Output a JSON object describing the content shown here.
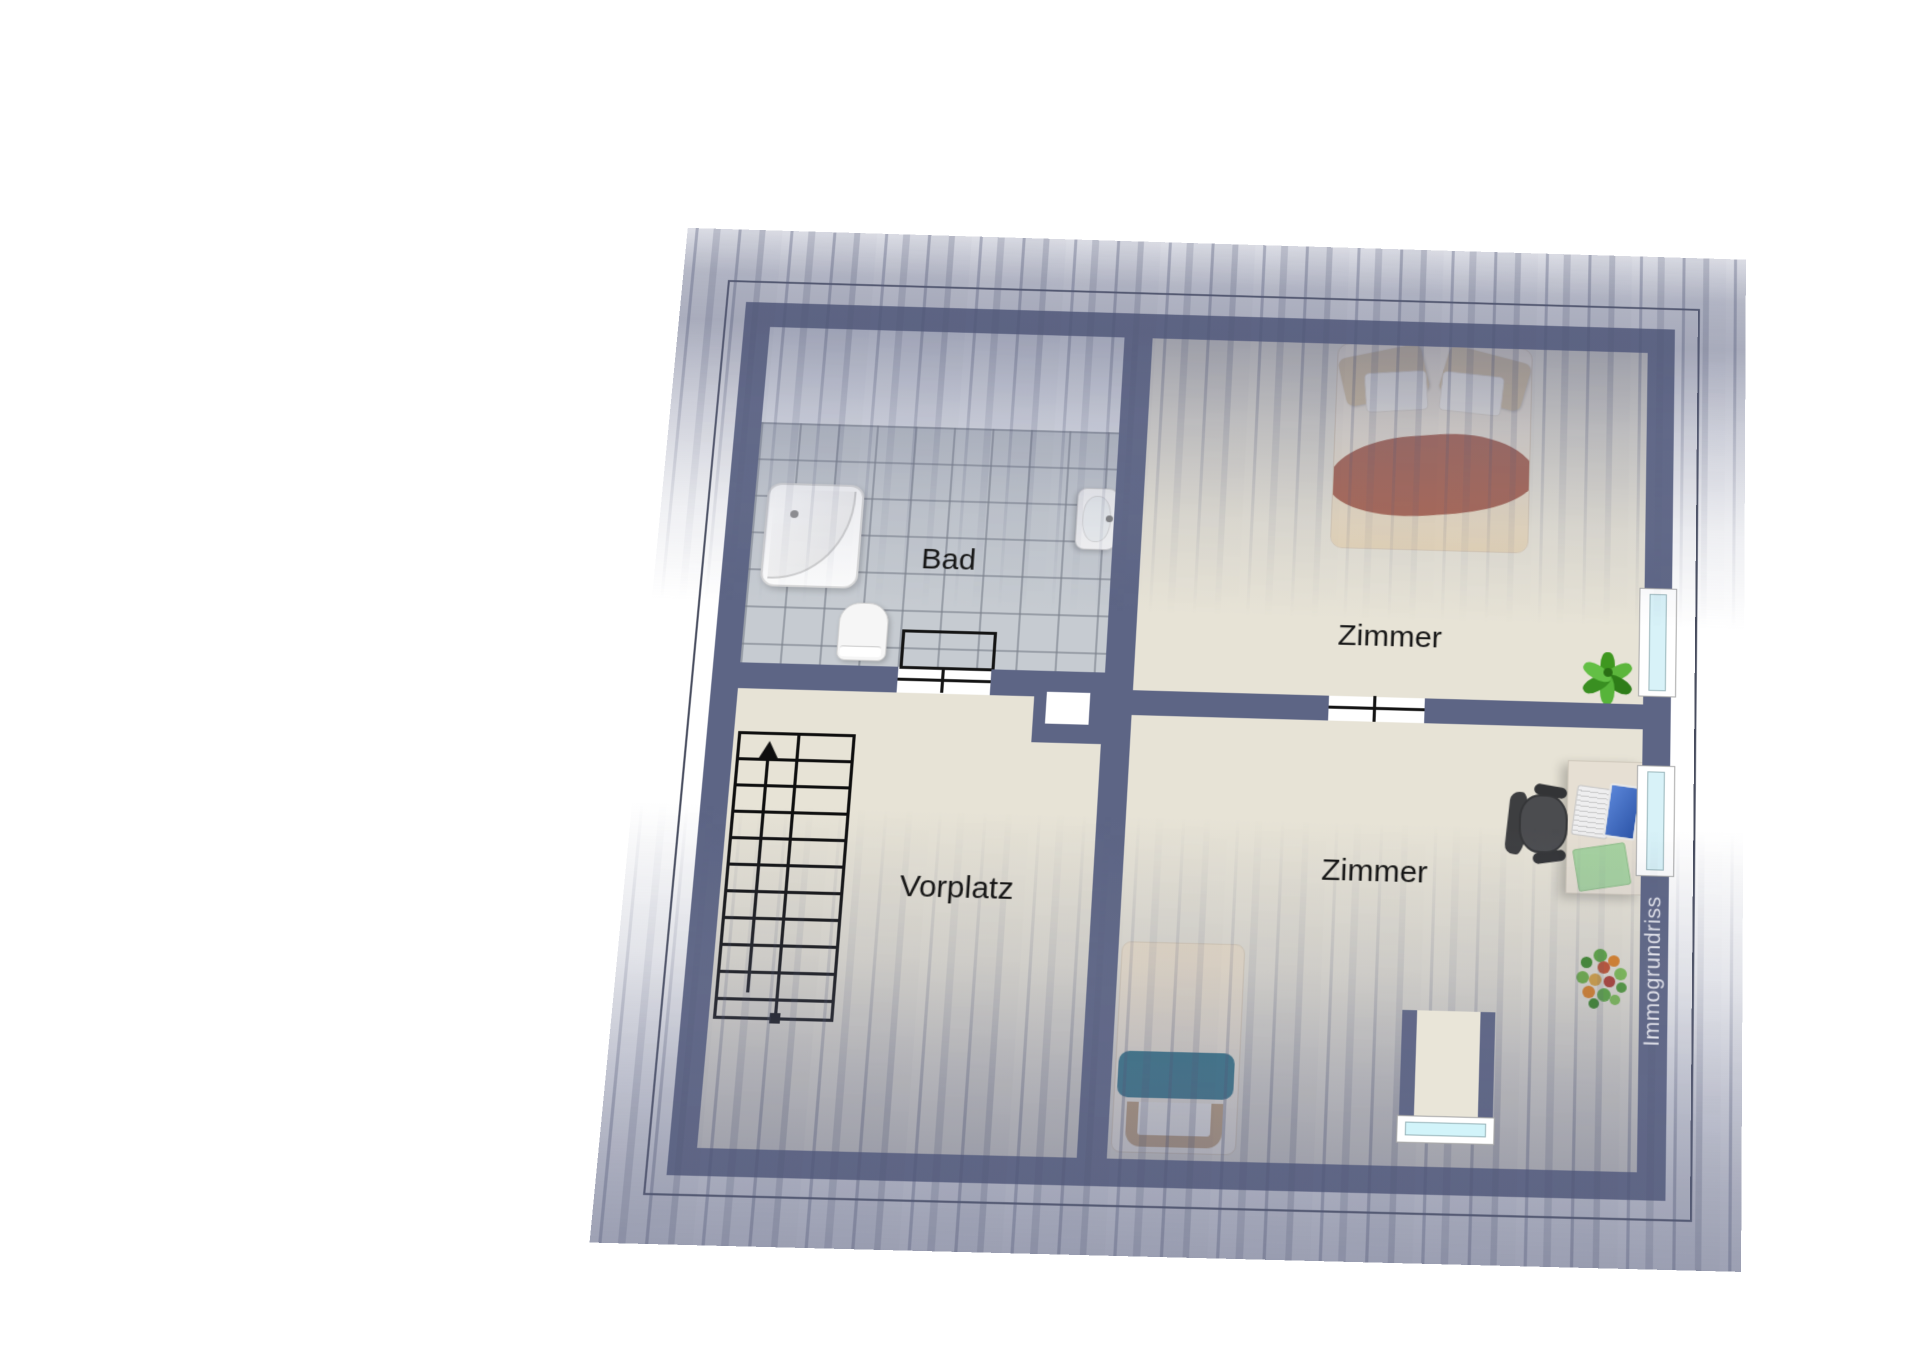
{
  "document": {
    "type": "floor-plan",
    "storey": "attic (sloped-roof storey)",
    "watermark": {
      "text": "Immogrundriss"
    }
  },
  "labels": {
    "bad": "Bad",
    "vorplatz": "Vorplatz",
    "zimmer_top": "Zimmer",
    "zimmer_bottom": "Zimmer"
  },
  "rooms": [
    {
      "id": "bad",
      "label": "Bad",
      "features": [
        "corner-bathtub",
        "toilet",
        "washbasin",
        "gray-tile-floor"
      ]
    },
    {
      "id": "vorplatz",
      "label": "Vorplatz",
      "features": [
        "staircase-with-up-arrow",
        "chimney-shaft"
      ]
    },
    {
      "id": "zimmer-top",
      "label": "Zimmer",
      "features": [
        "double-bed",
        "plant",
        "window-right"
      ]
    },
    {
      "id": "zimmer-bottom",
      "label": "Zimmer",
      "features": [
        "single-bed",
        "desk",
        "laptop",
        "office-chair",
        "green-folder",
        "flower-bouquet",
        "window-right",
        "dormer-window-bottom"
      ]
    }
  ],
  "windows": {
    "right_wall": 2,
    "dormer_bottom": 1,
    "glass_color": "#d8f2f8"
  },
  "colors": {
    "wall": "#5d6585",
    "floor": "#e7e3d6",
    "tile": "#c6cbd1",
    "roof_shading": "#61678a",
    "teal_blanket": "#2f7587",
    "bed_blanket_red": "#ab6450",
    "plant_green": "#3e971f",
    "outline": "#474c5e"
  }
}
